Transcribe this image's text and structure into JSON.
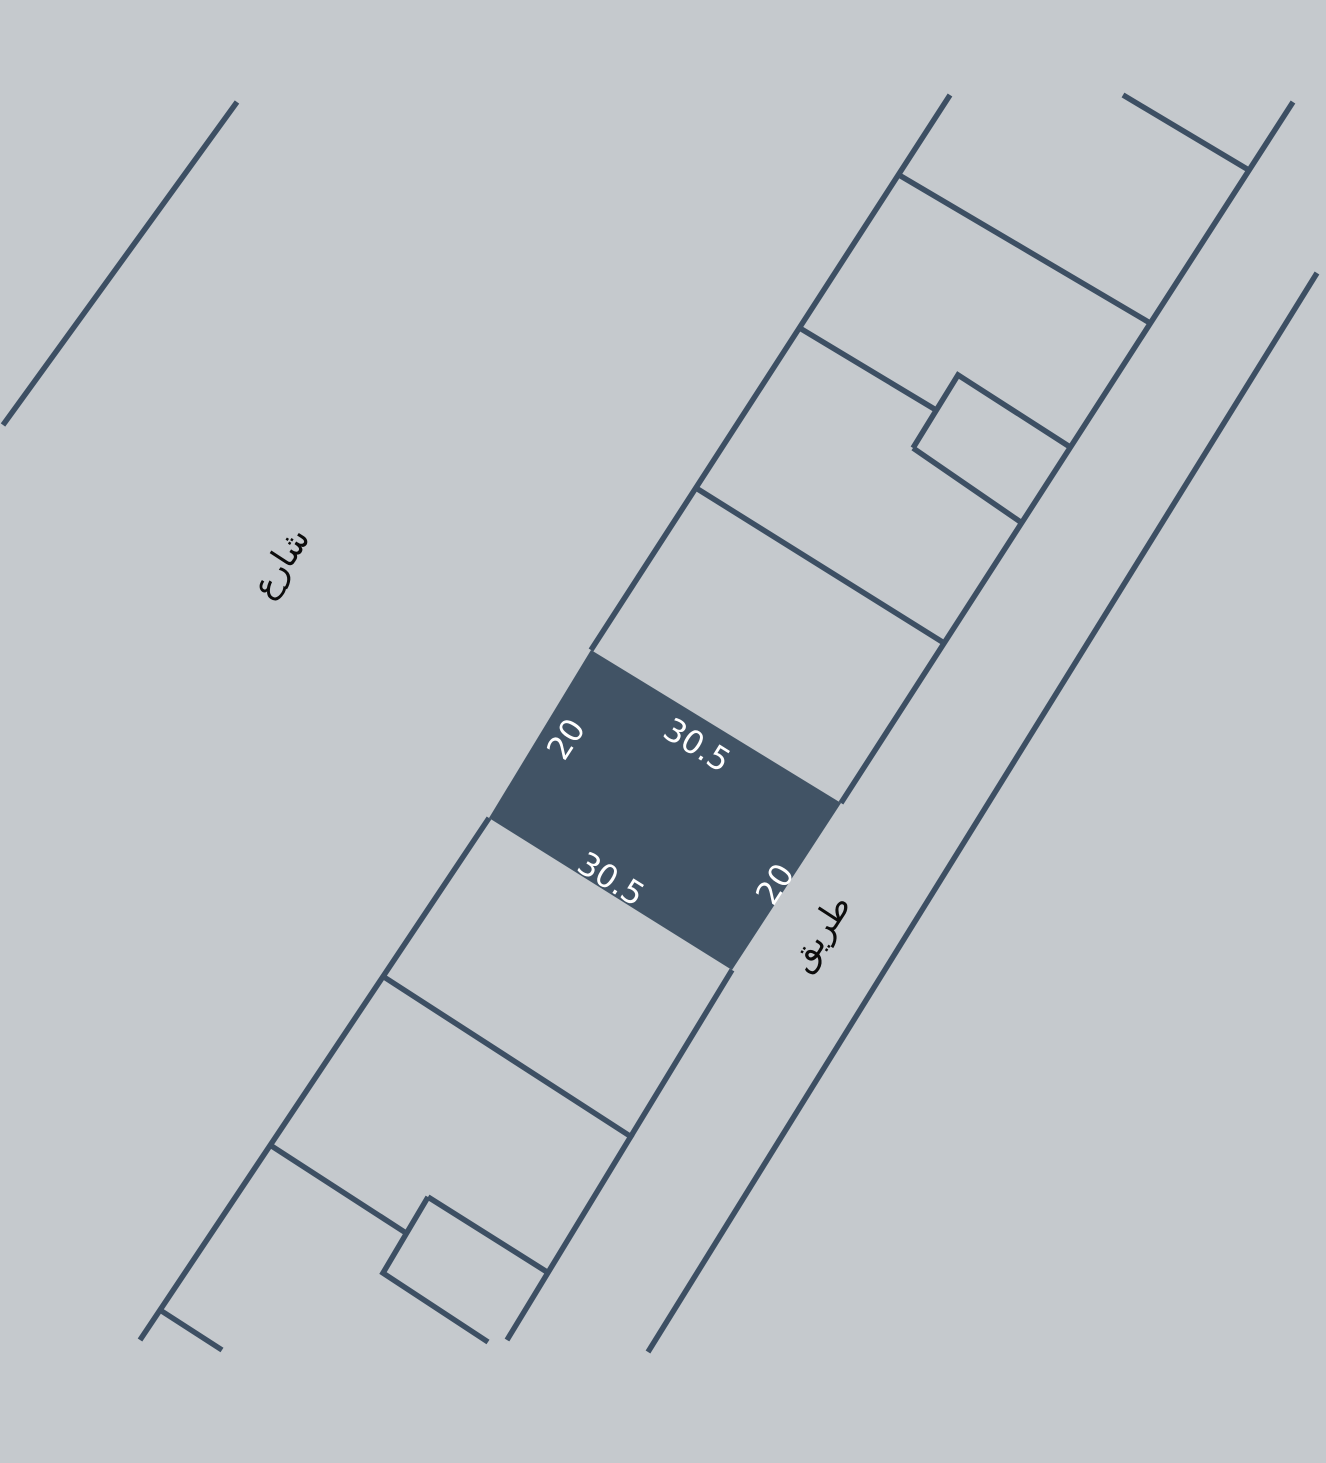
{
  "map": {
    "street_label": "شارع",
    "road_label": "طريق",
    "highlighted_parcel": {
      "dimensions": {
        "top": "30.5",
        "bottom": "30.5",
        "left": "20",
        "right": "20"
      },
      "frontage_m": 30.5,
      "depth_m": 20
    }
  },
  "colors": {
    "background": "#c5c9cd",
    "line": "#3d4f63",
    "parcel_fill": "#415365",
    "dimension_text": "#ffffff",
    "street_text": "#0c0c0c"
  }
}
